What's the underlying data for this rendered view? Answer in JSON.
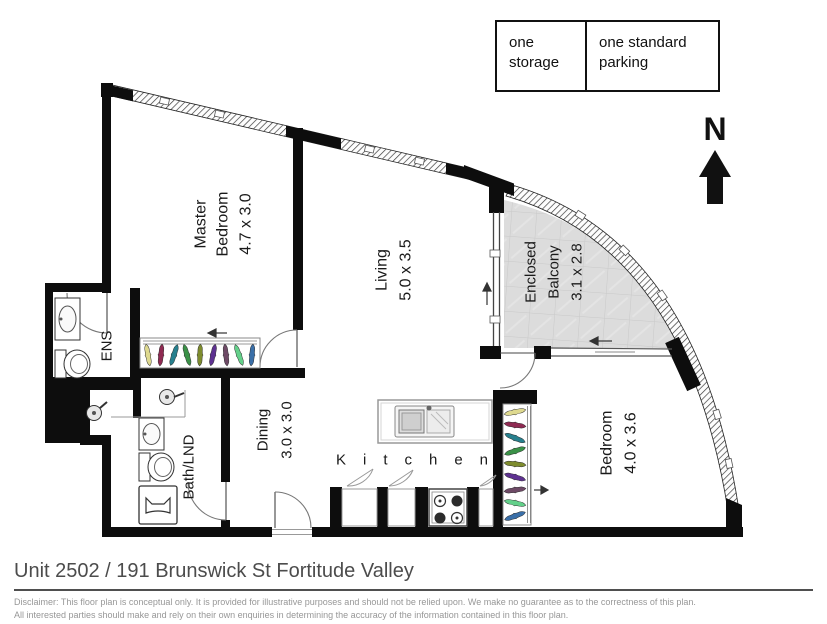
{
  "amenities": {
    "storage": "one storage",
    "parking": "one standard parking"
  },
  "compass": {
    "north_label": "N"
  },
  "rooms": {
    "master_bedroom": {
      "name_line1": "Master",
      "name_line2": "Bedroom",
      "dims": "4.7 x 3.0"
    },
    "living": {
      "name": "Living",
      "dims": "5.0 x 3.5"
    },
    "enclosed_balcony": {
      "name_line1": "Enclosed",
      "name_line2": "Balcony",
      "dims": "3.1 x 2.8"
    },
    "dining": {
      "name": "Dining",
      "dims": "3.0 x 3.0"
    },
    "bath_laundry": {
      "name": "Bath/LND"
    },
    "ensuite": {
      "name": "ENS"
    },
    "bedroom": {
      "name": "Bedroom",
      "dims": "4.0 x 3.6"
    },
    "kitchen": {
      "name": "Kitchen"
    }
  },
  "footer": {
    "address": "Unit 2502 / 191 Brunswick St Fortitude Valley",
    "disclaimer_line1": "Disclaimer: This floor plan is conceptual only. It is provided for illustrative purposes and should not be relied upon. We make no guarantee as to the correctness of this plan.",
    "disclaimer_line2": "All interested parties should make and rely on their own enquiries in determining the accuracy of the information contained in this floor plan."
  },
  "colors": {
    "wall": "#0d0d0d",
    "balcony_floor": "#dcdcdc",
    "title_text": "#4c4c4c",
    "disclaimer_text": "#979797",
    "hanger_palette": [
      "#ded98f",
      "#8f2a52",
      "#27808e",
      "#3a9147",
      "#7e8c2e",
      "#5e3191",
      "#6e4a66",
      "#63d08a",
      "#3a6fa8"
    ]
  }
}
